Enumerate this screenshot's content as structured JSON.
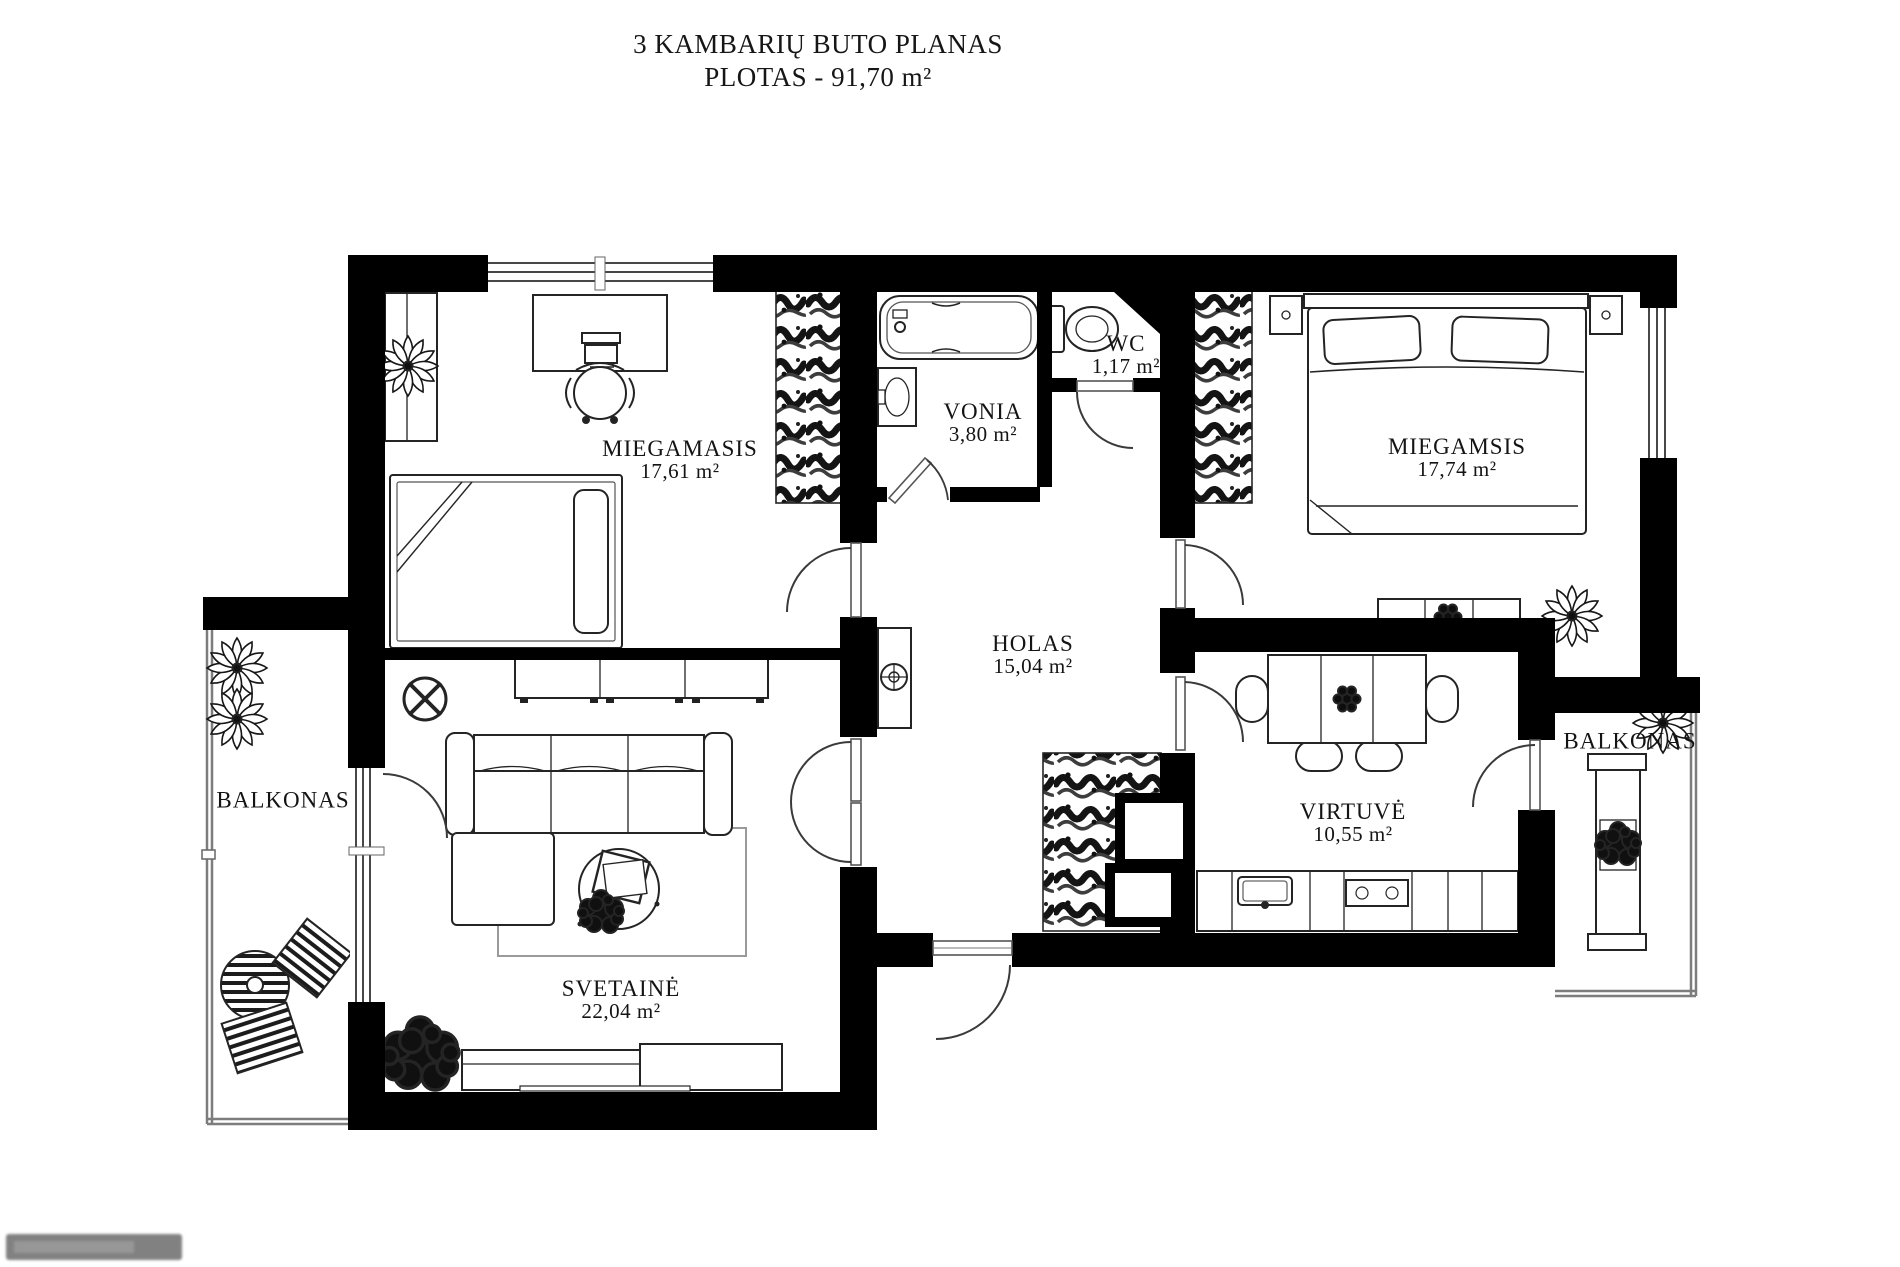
{
  "title": {
    "line1": "3 KAMBARIŲ BUTO PLANAS",
    "line2": "PLOTAS - 91,70 m²"
  },
  "rooms": {
    "miegamasis1": {
      "name": "MIEGAMASIS",
      "area": "17,61 m²"
    },
    "vonia": {
      "name": "VONIA",
      "area": "3,80 m²"
    },
    "wc": {
      "name": "WC",
      "area": "1,17 m²"
    },
    "miegamasis2": {
      "name": "MIEGAMSIS",
      "area": "17,74 m²"
    },
    "holas": {
      "name": "HOLAS",
      "area": "15,04 m²"
    },
    "virtuve": {
      "name": "VIRTUVĖ",
      "area": "10,55 m²"
    },
    "svetaine": {
      "name": "SVETAINĖ",
      "area": "22,04 m²"
    },
    "balkonas_left": {
      "name": "BALKONAS"
    },
    "balkonas_right": {
      "name": "BALKONAS"
    }
  },
  "colors": {
    "wall": "#000000",
    "background": "#ffffff",
    "furniture_line": "#222222"
  }
}
